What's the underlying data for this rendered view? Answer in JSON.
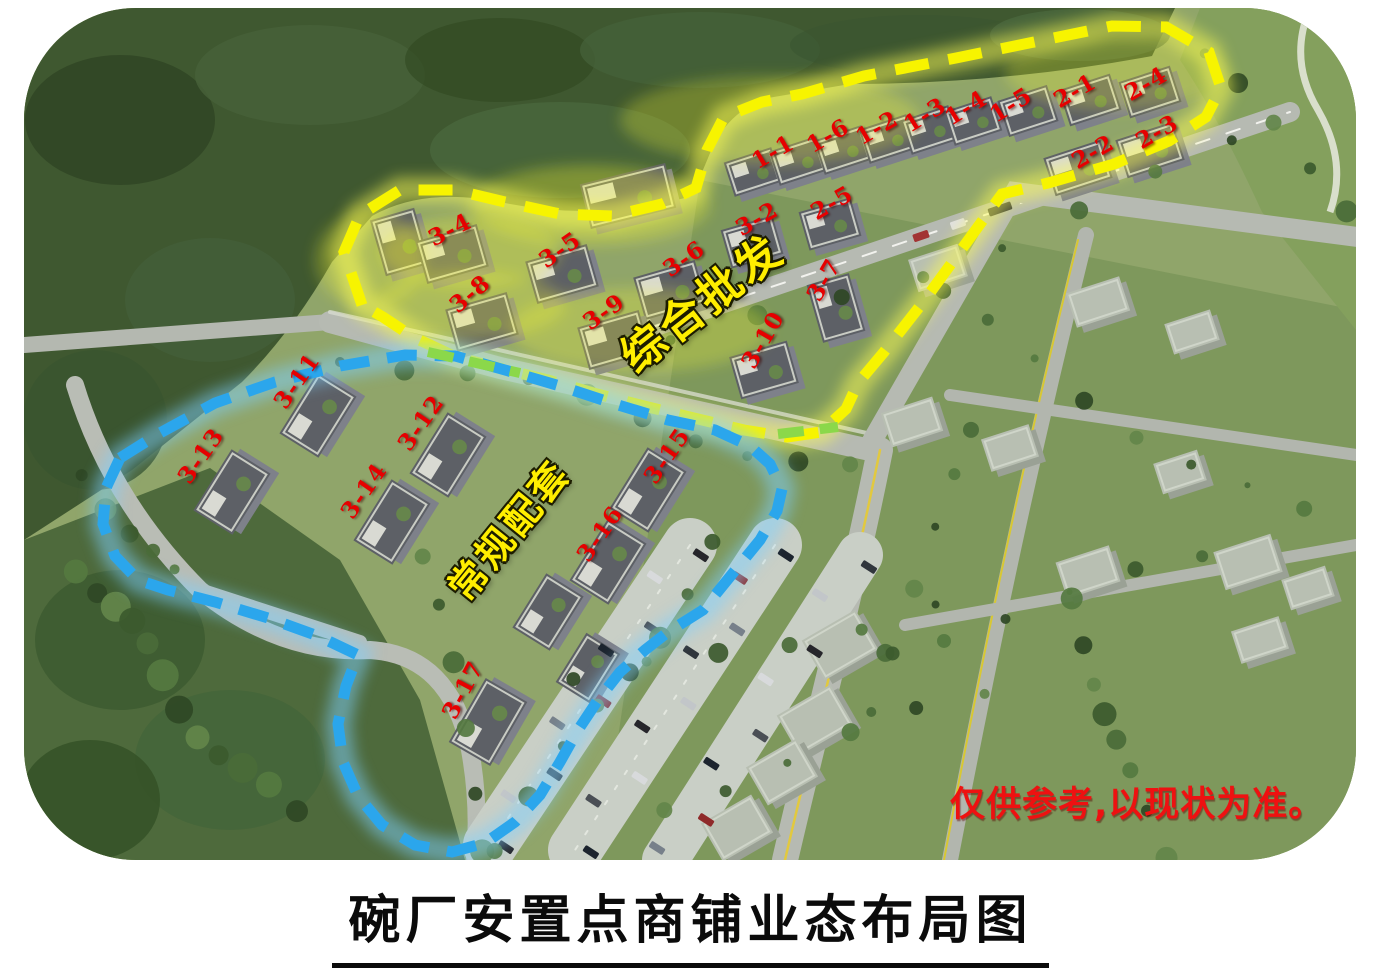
{
  "page": {
    "title": "碗厂安置点商铺业态布局图",
    "disclaimer": "仅供参考,以现状为准。"
  },
  "label_style": {
    "color": "#e60000"
  },
  "zones": [
    {
      "id": "wholesale",
      "name": "综合批发",
      "x": 700,
      "y": 300,
      "rotation": -38,
      "font_size": 44,
      "text_color": "#ffee00",
      "boundary_color": "#f7f400"
    },
    {
      "id": "standard",
      "name": "常规配套",
      "x": 507,
      "y": 528,
      "rotation": -51,
      "font_size": 38,
      "text_color": "#ffee00",
      "boundary_color": "#2ba6ec"
    }
  ],
  "building_labels": [
    {
      "text": "1-1",
      "x": 773,
      "y": 152,
      "rot": -30
    },
    {
      "text": "1-6",
      "x": 828,
      "y": 136,
      "rot": -30
    },
    {
      "text": "1-2",
      "x": 877,
      "y": 128,
      "rot": -30
    },
    {
      "text": "1-3",
      "x": 925,
      "y": 115,
      "rot": -32
    },
    {
      "text": "1-4",
      "x": 966,
      "y": 108,
      "rot": -32
    },
    {
      "text": "1-5",
      "x": 1011,
      "y": 105,
      "rot": -32
    },
    {
      "text": "2-1",
      "x": 1075,
      "y": 91,
      "rot": -30
    },
    {
      "text": "2-4",
      "x": 1146,
      "y": 84,
      "rot": -30
    },
    {
      "text": "2-2",
      "x": 1093,
      "y": 152,
      "rot": -30
    },
    {
      "text": "2-3",
      "x": 1157,
      "y": 132,
      "rot": -30
    },
    {
      "text": "3-2",
      "x": 757,
      "y": 219,
      "rot": -30
    },
    {
      "text": "2-5",
      "x": 832,
      "y": 203,
      "rot": -30
    },
    {
      "text": "3-4",
      "x": 450,
      "y": 230,
      "rot": -27
    },
    {
      "text": "3-5",
      "x": 560,
      "y": 250,
      "rot": -35
    },
    {
      "text": "3-6",
      "x": 684,
      "y": 259,
      "rot": -35
    },
    {
      "text": "3-8",
      "x": 470,
      "y": 294,
      "rot": -40
    },
    {
      "text": "3-9",
      "x": 604,
      "y": 312,
      "rot": -35
    },
    {
      "text": "3-7",
      "x": 824,
      "y": 280,
      "rot": -60
    },
    {
      "text": "3-10",
      "x": 763,
      "y": 340,
      "rot": -60
    },
    {
      "text": "3-11",
      "x": 297,
      "y": 381,
      "rot": -55
    },
    {
      "text": "3-12",
      "x": 421,
      "y": 423,
      "rot": -55
    },
    {
      "text": "3-13",
      "x": 201,
      "y": 456,
      "rot": -55
    },
    {
      "text": "3-14",
      "x": 364,
      "y": 491,
      "rot": -55
    },
    {
      "text": "3-15",
      "x": 667,
      "y": 456,
      "rot": -55
    },
    {
      "text": "3-16",
      "x": 600,
      "y": 534,
      "rot": -55
    },
    {
      "text": "3-17",
      "x": 463,
      "y": 690,
      "rot": -62
    }
  ]
}
